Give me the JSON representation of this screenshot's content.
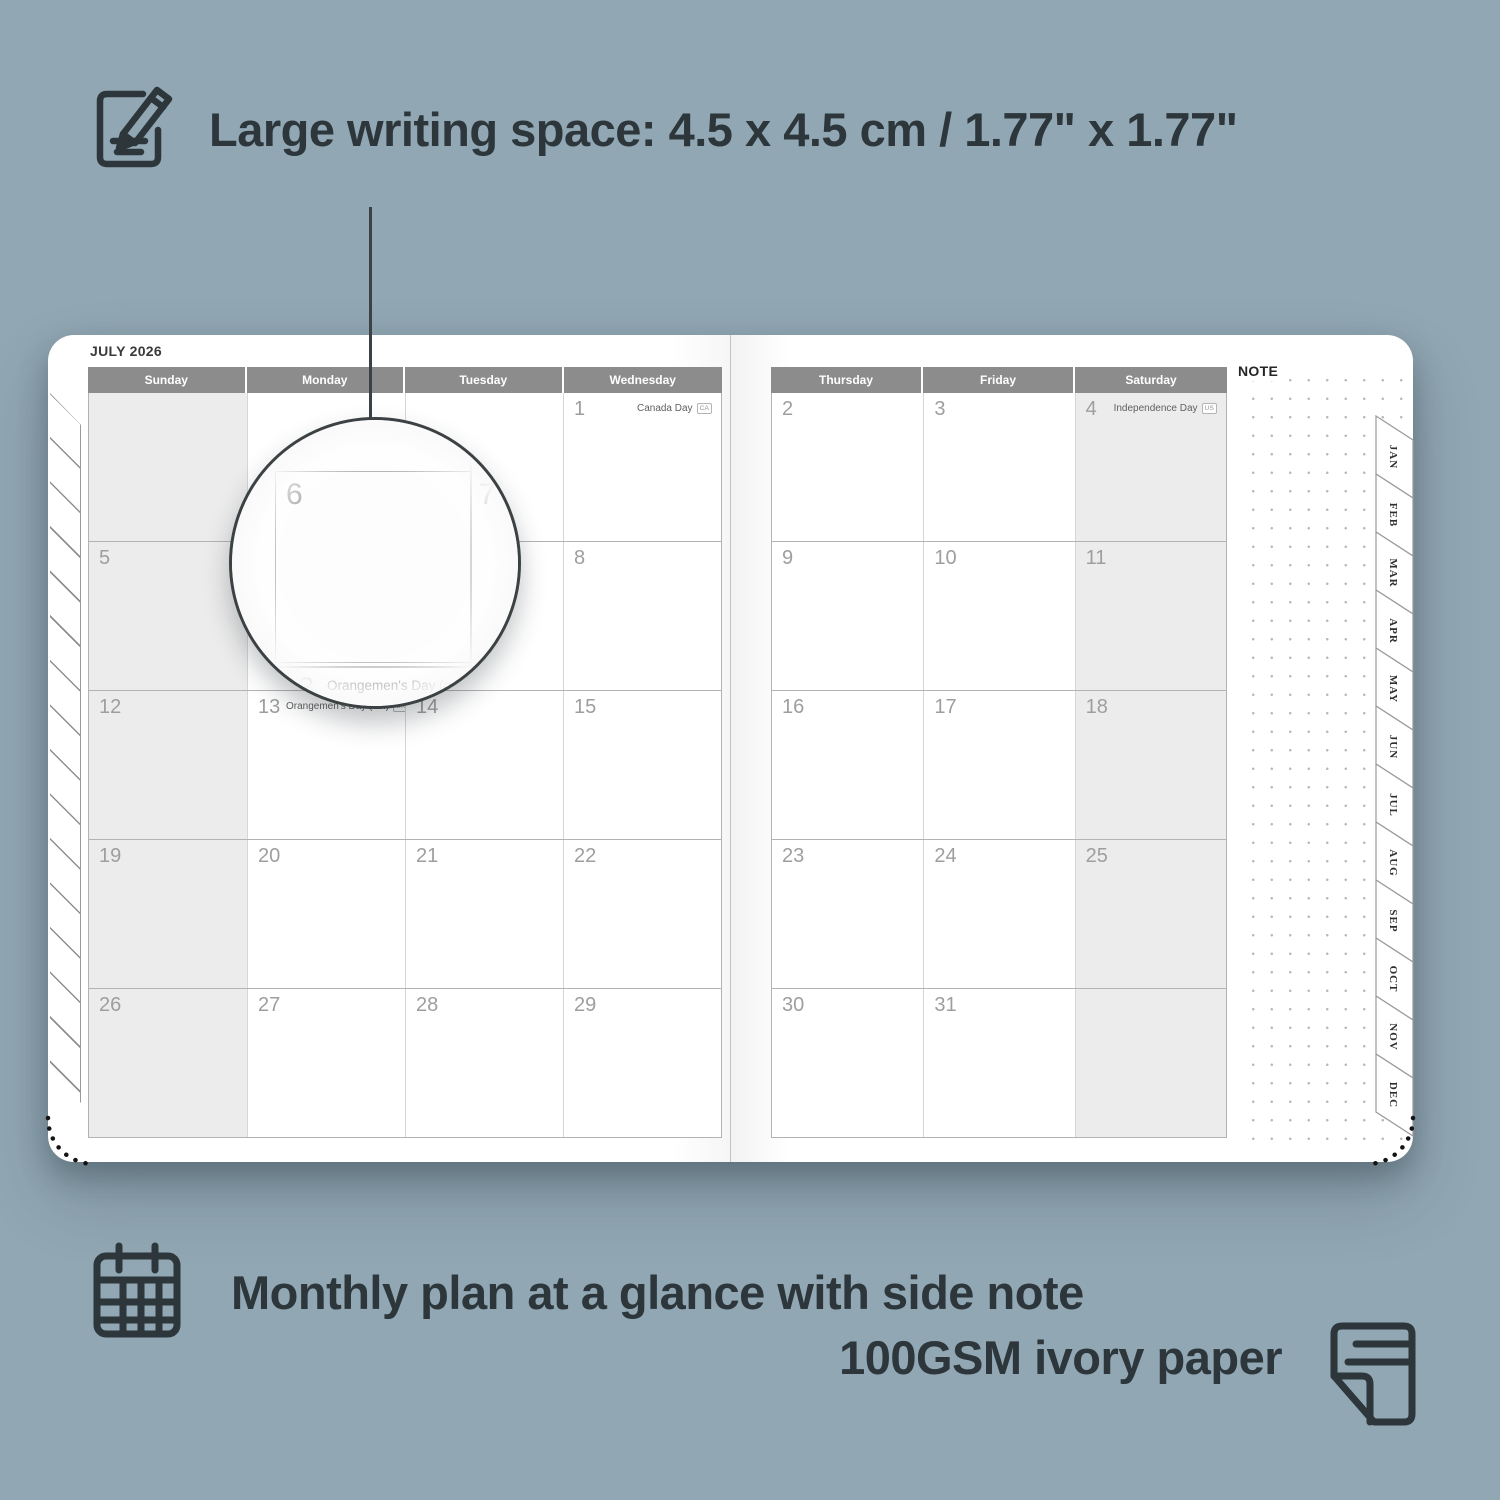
{
  "colors": {
    "background": "#91a7b3",
    "ink": "#2c363b",
    "header_gray": "#8c8c8c",
    "weekend_shade": "#ececec",
    "day_number": "#9e9e9e"
  },
  "feature_top": {
    "icon": "notepad-pencil-icon",
    "label": "Large writing space: 4.5 x 4.5 cm / 1.77\" x 1.77\""
  },
  "feature_bottom": {
    "icon": "calendar-grid-icon",
    "label": "Monthly plan at a glance with side note"
  },
  "feature_paper": {
    "icon": "paper-sheet-icon",
    "label": "100GSM ivory paper"
  },
  "planner": {
    "month_title": "JULY 2026",
    "note_label": "NOTE",
    "left_page": {
      "headers": [
        "Sunday",
        "Monday",
        "Tuesday",
        "Wednesday"
      ],
      "shaded_column": 0,
      "rows": [
        [
          {
            "day": ""
          },
          {
            "day": ""
          },
          {
            "day": ""
          },
          {
            "day": "1",
            "holiday": "Canada Day",
            "badge": "CA",
            "align": "right"
          }
        ],
        [
          {
            "day": "5"
          },
          {
            "day": "6"
          },
          {
            "day": "7"
          },
          {
            "day": "8"
          }
        ],
        [
          {
            "day": "12"
          },
          {
            "day": "13",
            "holiday": "Orangemen's Day (n.i.)",
            "badge": "UK",
            "align": "left"
          },
          {
            "day": "14"
          },
          {
            "day": "15"
          }
        ],
        [
          {
            "day": "19"
          },
          {
            "day": "20"
          },
          {
            "day": "21"
          },
          {
            "day": "22"
          }
        ],
        [
          {
            "day": "26"
          },
          {
            "day": "27"
          },
          {
            "day": "28"
          },
          {
            "day": "29"
          }
        ]
      ]
    },
    "right_page": {
      "headers": [
        "Thursday",
        "Friday",
        "Saturday"
      ],
      "shaded_column": 2,
      "rows": [
        [
          {
            "day": "2"
          },
          {
            "day": "3"
          },
          {
            "day": "4",
            "holiday": "Independence Day",
            "badge": "US",
            "align": "right"
          }
        ],
        [
          {
            "day": "9"
          },
          {
            "day": "10"
          },
          {
            "day": "11"
          }
        ],
        [
          {
            "day": "16"
          },
          {
            "day": "17"
          },
          {
            "day": "18"
          }
        ],
        [
          {
            "day": "23"
          },
          {
            "day": "24"
          },
          {
            "day": "25"
          }
        ],
        [
          {
            "day": "30"
          },
          {
            "day": "31"
          },
          {
            "day": ""
          }
        ]
      ]
    },
    "tabs": [
      "JAN",
      "FEB",
      "MAR",
      "APR",
      "MAY",
      "JUN",
      "JUL",
      "AUG",
      "SEP",
      "OCT",
      "NOV",
      "DEC"
    ],
    "magnifier": {
      "day_left": "6",
      "day_right": "7",
      "below_day": "13",
      "caption": "Orangemen's Day (n.i.)",
      "badge": "UK"
    }
  }
}
